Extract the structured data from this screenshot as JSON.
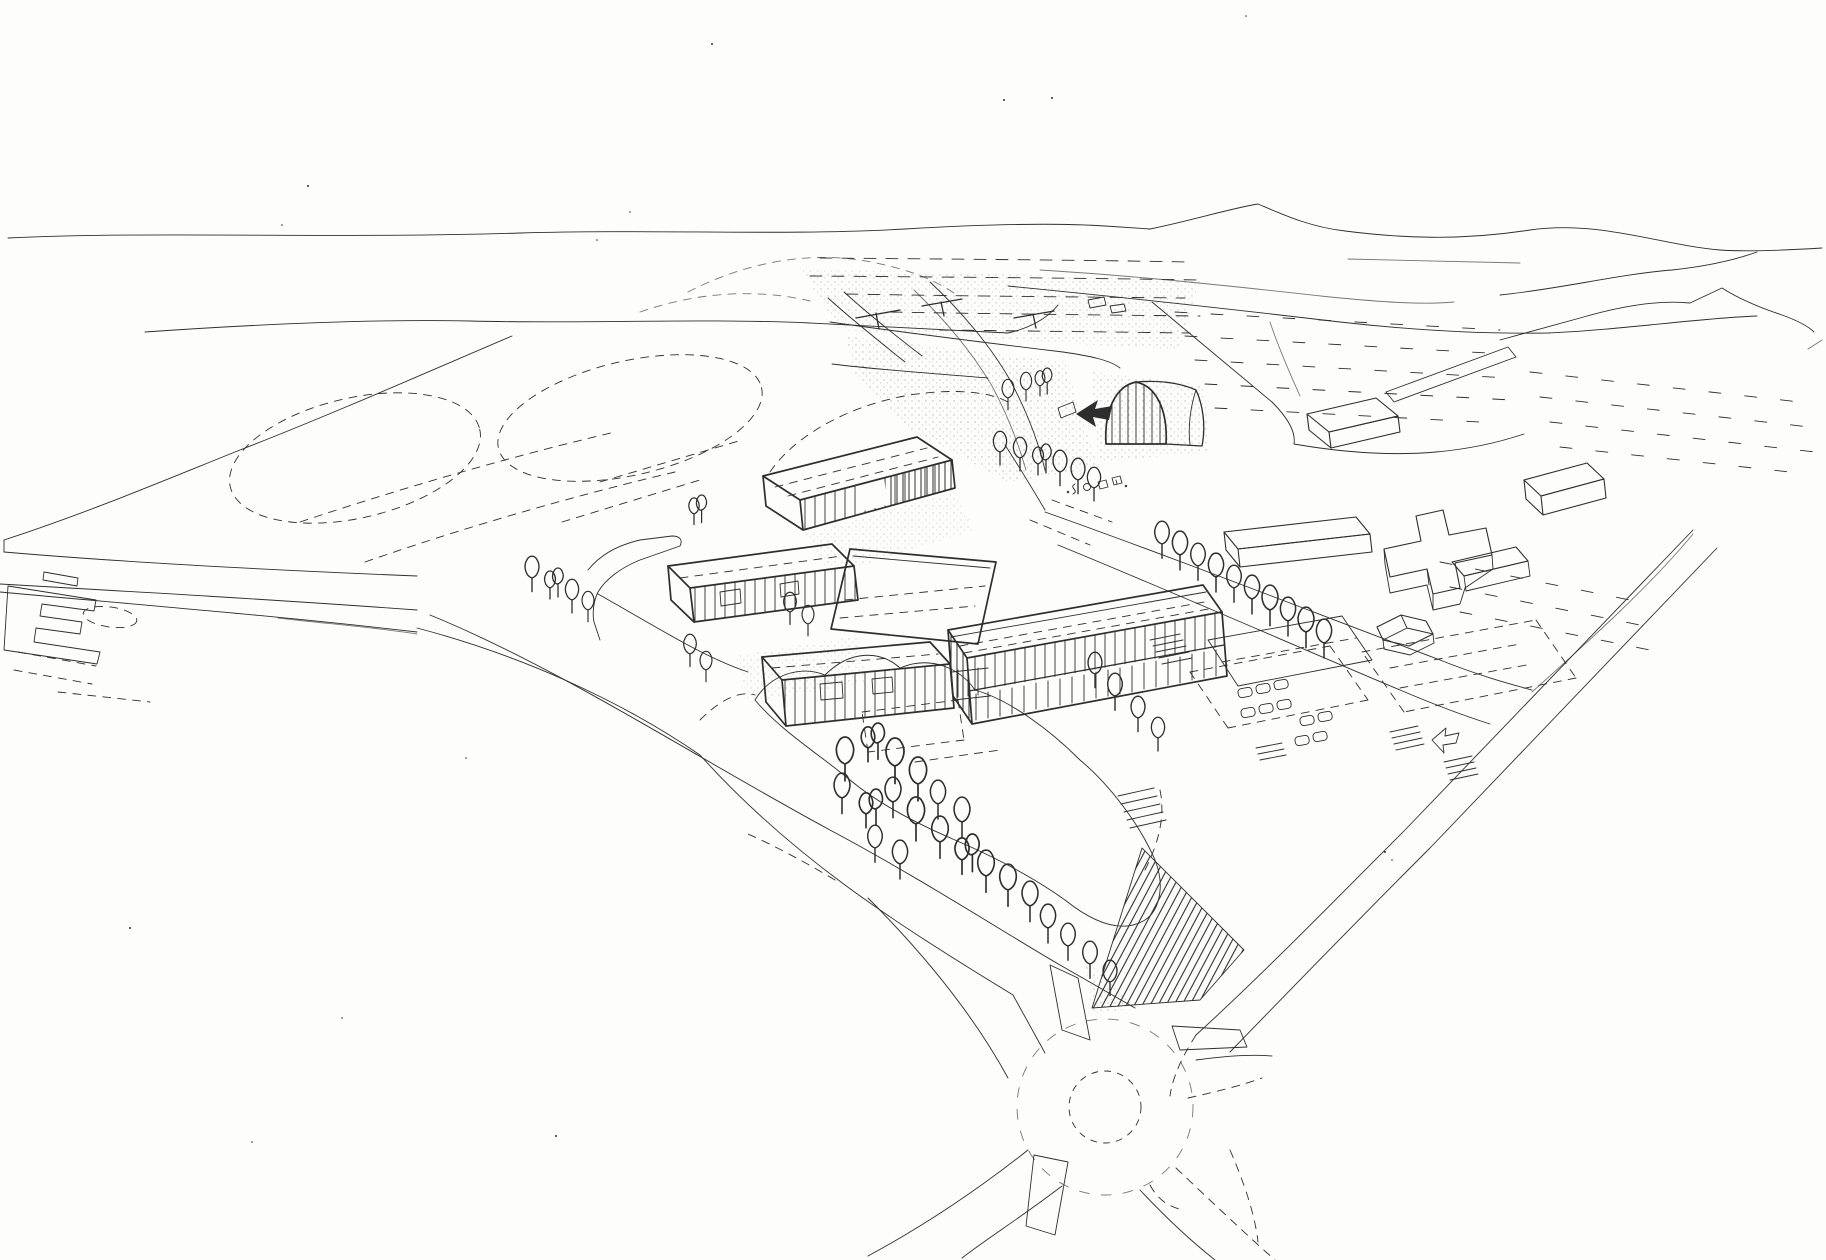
{
  "canvas": {
    "width": 1826,
    "height": 1260
  },
  "colors": {
    "paper": "#fdfdfb",
    "ink": "#2e2e2e"
  },
  "scene": {
    "description": "Hand-drawn aerial perspective sketch of a campus masterplan: striped slab buildings around courtyards, a barrel-vaulted hall with a solid entrance arrow, tree rows and a grove, parking lots with cars, dashed sports fields, surrounding farm fields with tick rows, a highway, and a four-arm roundabout with hatched embankment",
    "marks": {
      "entrance_arrow": "solid-left-arrow",
      "roundabout": "dashed-circle",
      "embankment": "diagonal-hatch-wedge",
      "facades": "vertical-stripe-hatching",
      "fields": "dashed-tick-rows",
      "trees": "balloon-outline-with-trunk"
    }
  }
}
